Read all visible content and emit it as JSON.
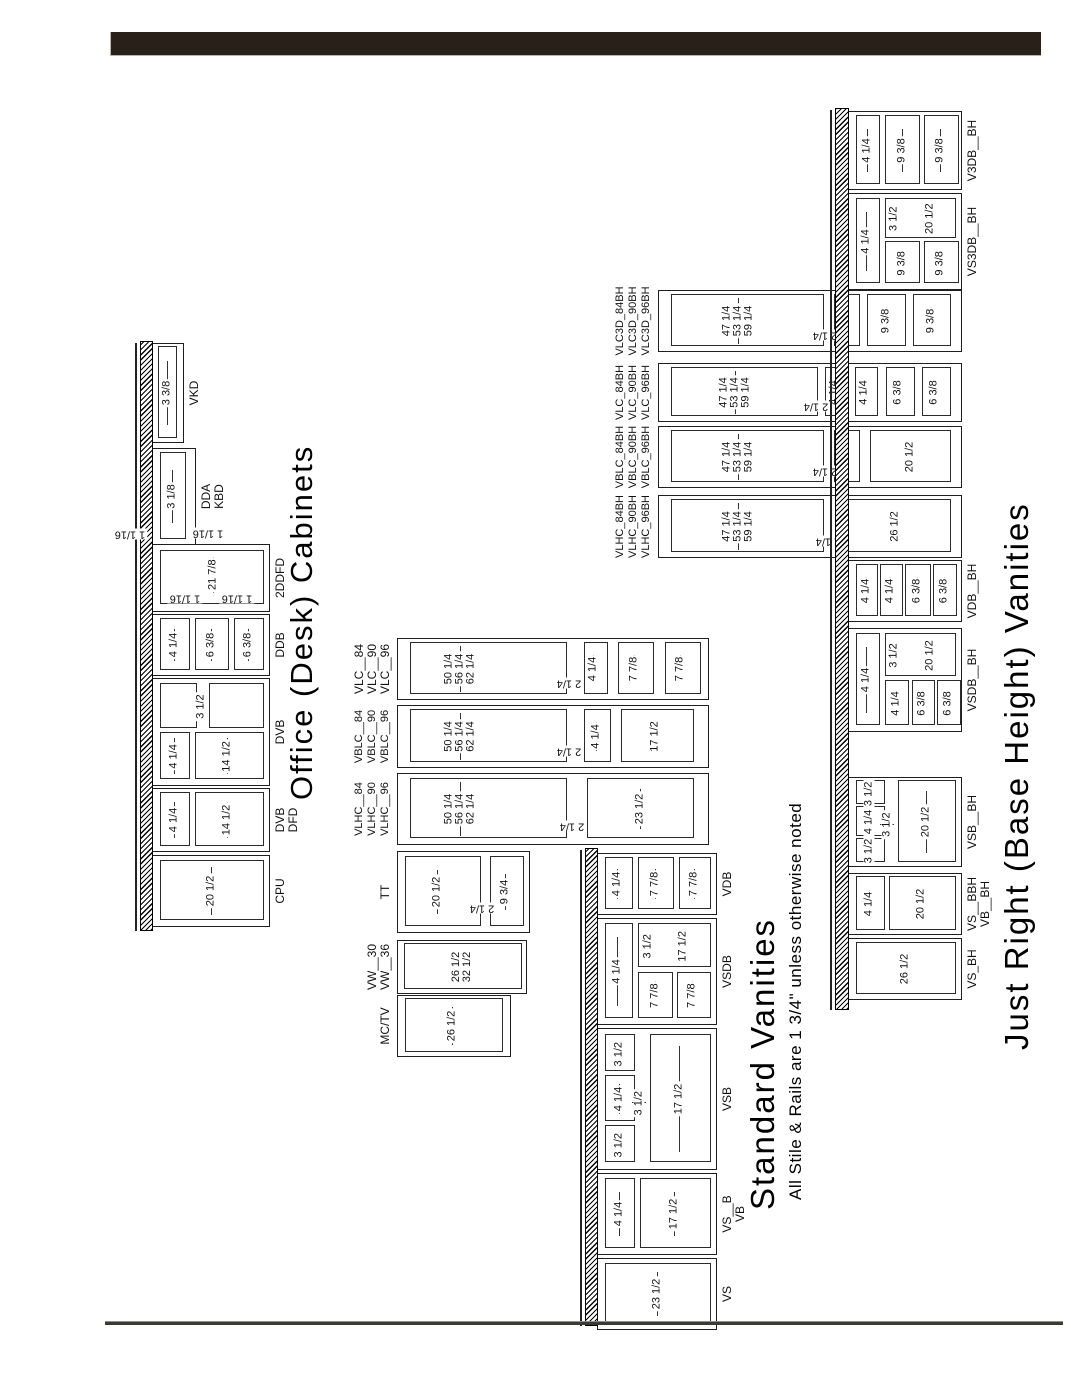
{
  "page": {
    "header_bar_color": "#292019",
    "line_color": "#1e1e1e",
    "background": "#ffffff"
  },
  "office": {
    "title": "Office (Desk) Cabinets",
    "extra_dim": "1 1/16",
    "cabinets": [
      {
        "id": "cpu",
        "label": [
          "CPU"
        ],
        "dims": [
          "20 1/2"
        ]
      },
      {
        "id": "dvb-dfd",
        "label": [
          "DVB",
          "DFD"
        ],
        "dims": [
          "4 1/4",
          "14 1/2"
        ]
      },
      {
        "id": "dvb",
        "label": [
          "DVB"
        ],
        "dims": [
          "4 1/4",
          "14 1/2",
          "3 1/2"
        ]
      },
      {
        "id": "ddb",
        "label": [
          "DDB"
        ],
        "dims": [
          "4 1/4",
          "6 3/8",
          "6 3/8"
        ]
      },
      {
        "id": "2ddfd",
        "label": [
          "2DDFD"
        ],
        "dims": [
          "21 7/8",
          "1 1/16",
          "1 1/16"
        ]
      },
      {
        "id": "dda-kbd",
        "label": [
          "DDA",
          "KBD"
        ],
        "dims": [
          "3 1/8",
          "1 1/16"
        ]
      },
      {
        "id": "vkd",
        "label": [
          "VKD"
        ],
        "dims": [
          "3 3/8"
        ]
      }
    ]
  },
  "standard": {
    "title": "Standard Vanities",
    "subtitle": "All Stile & Rails are 1 3/4\" unless otherwise noted",
    "wall_cabinets": [
      {
        "id": "mc-tv",
        "label": [
          "MC/TV"
        ],
        "dims": [
          "26 1/2"
        ]
      },
      {
        "id": "vw",
        "label": [
          "VW__30",
          "VW__36"
        ],
        "dims": [
          "26 1/2",
          "32 1/2"
        ]
      },
      {
        "id": "tt",
        "label": [
          "TT"
        ],
        "dims": [
          "20 1/2",
          "2 1/4",
          "9 3/4"
        ]
      }
    ],
    "tall_cabinets": [
      {
        "id": "vlhc",
        "label": [
          "VLHC__84",
          "VLHC__90",
          "VLHC__96"
        ],
        "dims": [
          "50 1/4",
          "56 1/4",
          "62 1/4",
          "2 1/4",
          "23 1/2"
        ]
      },
      {
        "id": "vblc",
        "label": [
          "VBLC__84",
          "VBLC__90",
          "VBLC__96"
        ],
        "dims": [
          "50 1/4",
          "56 1/4",
          "62 1/4",
          "2 1/4",
          "4 1/4",
          "17 1/2"
        ]
      },
      {
        "id": "vlc",
        "label": [
          "VLC__84",
          "VLC__90",
          "VLC__96"
        ],
        "dims": [
          "50 1/4",
          "56 1/4",
          "62 1/4",
          "2 1/4",
          "4 1/4",
          "7 7/8",
          "7 7/8"
        ]
      }
    ],
    "base_cabinets": [
      {
        "id": "vs",
        "label": [
          "VS"
        ],
        "dims": [
          "23 1/2"
        ]
      },
      {
        "id": "vs-b",
        "label": [
          "VS__B",
          "VB"
        ],
        "dims": [
          "4 1/4",
          "17 1/2"
        ]
      },
      {
        "id": "vsb",
        "label": [
          "VSB"
        ],
        "dims": [
          "3 1/2",
          "4 1/4",
          "3 1/2",
          "3 1/2",
          "17 1/2"
        ]
      },
      {
        "id": "vsdb",
        "label": [
          "VSDB"
        ],
        "dims": [
          "4 1/4",
          "3 1/2",
          "17 1/2",
          "7 7/8",
          "7 7/8"
        ]
      },
      {
        "id": "vdb",
        "label": [
          "VDB"
        ],
        "dims": [
          "4 1/4",
          "7 7/8",
          "7 7/8"
        ]
      }
    ]
  },
  "just_right": {
    "title": "Just Right (Base Height) Vanities",
    "tall_cabinets": [
      {
        "id": "vlhc-bh",
        "label": [
          "VLHC_84BH",
          "VLHC_90BH",
          "VLHC_96BH"
        ],
        "dims": [
          "47 1/4",
          "53 1/4",
          "59 1/4",
          "2 1/4",
          "26 1/2"
        ]
      },
      {
        "id": "vblc-bh",
        "label": [
          "VBLC_84BH",
          "VBLC_90BH",
          "VBLC_96BH"
        ],
        "dims": [
          "47 1/4",
          "53 1/4",
          "59 1/4",
          "2 1/4",
          "4 1/4",
          "20 1/2"
        ]
      },
      {
        "id": "vlc-bh",
        "label": [
          "VLC_84BH",
          "VLC_90BH",
          "VLC_96BH"
        ],
        "dims": [
          "47 1/4",
          "53 1/4",
          "59 1/4",
          "2 1/4",
          "4 1/4",
          "4 1/4",
          "6 3/8",
          "6 3/8"
        ]
      },
      {
        "id": "vlc3d-bh",
        "label": [
          "VLC3D_84BH",
          "VLC3D_90BH",
          "VLC3D_96BH"
        ],
        "dims": [
          "47 1/4",
          "53 1/4",
          "59 1/4",
          "2 1/4",
          "4 1/4",
          "9 3/8",
          "9 3/8"
        ]
      }
    ],
    "base_cabinets": [
      {
        "id": "vs-bh",
        "label": [
          "VS_BH"
        ],
        "dims": [
          "26 1/2"
        ]
      },
      {
        "id": "vs-bbh",
        "label": [
          "VS__BBH",
          "VB__BH"
        ],
        "dims": [
          "4 1/4",
          "20 1/2"
        ]
      },
      {
        "id": "vsb-bh",
        "label": [
          "VSB__BH"
        ],
        "dims": [
          "3 1/2",
          "4 1/4",
          "3 1/2",
          "3 1/2",
          "20 1/2"
        ]
      },
      {
        "id": "vsdb-bh",
        "label": [
          "VSDB__BH"
        ],
        "dims": [
          "4 1/4",
          "3 1/2",
          "20 1/2",
          "4 1/4",
          "6 3/8",
          "6 3/8"
        ]
      },
      {
        "id": "vdb-bh",
        "label": [
          "VDB__BH"
        ],
        "dims": [
          "4 1/4",
          "4 1/4",
          "6 3/8",
          "6 3/8"
        ]
      },
      {
        "id": "vs3db-bh",
        "label": [
          "VS3DB__BH"
        ],
        "dims": [
          "4 1/4",
          "3 1/2",
          "20 1/2",
          "9 3/8",
          "9 3/8"
        ]
      },
      {
        "id": "v3db-bh",
        "label": [
          "V3DB__BH"
        ],
        "dims": [
          "4 1/4",
          "9 3/8",
          "9 3/8"
        ]
      }
    ]
  }
}
